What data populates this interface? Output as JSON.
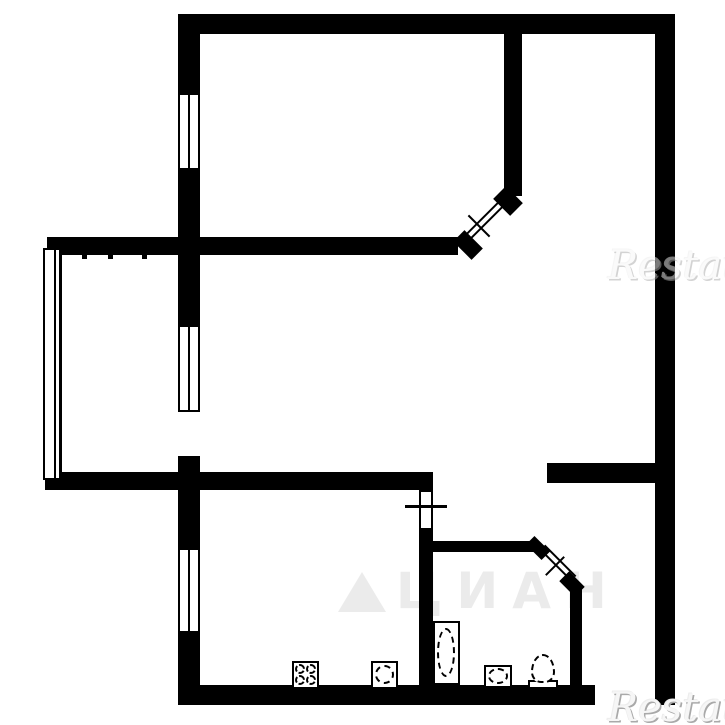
{
  "watermarks": {
    "brand_text": "Restate",
    "portal_text": "ЦИАН"
  },
  "colors": {
    "wall": "#000000",
    "background": "#ffffff",
    "portal_watermark": "#ebebeb",
    "brand_watermark": "#a9a9a9"
  },
  "plan": {
    "canvas": {
      "width": 725,
      "height": 725
    },
    "items": [
      {
        "name": "top-wall",
        "kind": "wall",
        "x": 178,
        "y": 14,
        "w": 497,
        "h": 20
      },
      {
        "name": "right-wall",
        "kind": "wall",
        "x": 655,
        "y": 14,
        "w": 20,
        "h": 691
      },
      {
        "name": "bedroom-left-wall-upper",
        "kind": "wall",
        "x": 178,
        "y": 14,
        "w": 22,
        "h": 79
      },
      {
        "name": "bedroom-left-wall-lower",
        "kind": "wall",
        "x": 178,
        "y": 170,
        "w": 22,
        "h": 85
      },
      {
        "name": "middle-wall",
        "kind": "wall",
        "x": 47,
        "y": 237,
        "w": 411,
        "h": 18
      },
      {
        "name": "bedroom-divider-wall",
        "kind": "wall",
        "x": 504,
        "y": 34,
        "w": 18,
        "h": 162
      },
      {
        "name": "balcony-door-wall-upper",
        "kind": "wall",
        "x": 178,
        "y": 255,
        "w": 22,
        "h": 70
      },
      {
        "name": "balcony-door-wall-lower",
        "kind": "wall",
        "x": 178,
        "y": 456,
        "w": 22,
        "h": 34
      },
      {
        "name": "lower-left-wall",
        "kind": "wall",
        "x": 45,
        "y": 472,
        "w": 388,
        "h": 18
      },
      {
        "name": "kitchen-left-wall-upper",
        "kind": "wall",
        "x": 178,
        "y": 490,
        "w": 22,
        "h": 58
      },
      {
        "name": "kitchen-left-wall-lower",
        "kind": "wall",
        "x": 178,
        "y": 633,
        "w": 22,
        "h": 72
      },
      {
        "name": "bottom-wall",
        "kind": "wall",
        "x": 178,
        "y": 685,
        "w": 417,
        "h": 20
      },
      {
        "name": "kitchen-bath-wall",
        "kind": "wall",
        "x": 419,
        "y": 530,
        "w": 14,
        "h": 160
      },
      {
        "name": "bathroom-top-wall",
        "kind": "wall",
        "x": 430,
        "y": 541,
        "w": 105,
        "h": 11
      },
      {
        "name": "bathroom-right-wall",
        "kind": "wall",
        "x": 570,
        "y": 588,
        "w": 12,
        "h": 102
      },
      {
        "name": "hall-wall",
        "kind": "wall",
        "x": 547,
        "y": 463,
        "w": 128,
        "h": 20
      },
      {
        "name": "wall-notch-1",
        "kind": "wall",
        "x": 82,
        "y": 255,
        "w": 5,
        "h": 4
      },
      {
        "name": "wall-notch-2",
        "kind": "wall",
        "x": 108,
        "y": 255,
        "w": 5,
        "h": 4
      },
      {
        "name": "wall-notch-3",
        "kind": "wall",
        "x": 142,
        "y": 255,
        "w": 5,
        "h": 4
      },
      {
        "name": "middle-wall-end-cap",
        "kind": "cap",
        "cx": 468,
        "cy": 245,
        "w": 26,
        "h": 16,
        "rot": 45
      },
      {
        "name": "bedroom-wall-end-cap",
        "kind": "cap",
        "cx": 508,
        "cy": 201,
        "w": 24,
        "h": 18,
        "rot": 45
      },
      {
        "name": "bathroom-wall-end-cap",
        "kind": "cap",
        "cx": 538,
        "cy": 548,
        "w": 22,
        "h": 12,
        "rot": 45
      },
      {
        "name": "bathroom-corner-cap",
        "kind": "cap",
        "cx": 572,
        "cy": 584,
        "w": 22,
        "h": 14,
        "rot": 45
      },
      {
        "name": "bedroom-window",
        "kind": "window",
        "x": 178,
        "y": 93,
        "w": 22,
        "h": 77
      },
      {
        "name": "balcony-door-window",
        "kind": "window",
        "x": 178,
        "y": 325,
        "w": 22,
        "h": 87
      },
      {
        "name": "kitchen-window",
        "kind": "window",
        "x": 178,
        "y": 548,
        "w": 22,
        "h": 85
      },
      {
        "name": "kitchen-bath-door-frame",
        "kind": "window",
        "x": 419,
        "y": 490,
        "w": 14,
        "h": 40,
        "mullion": false
      },
      {
        "name": "balcony-glazing",
        "kind": "glazing",
        "x": 43,
        "y": 248,
        "w": 19,
        "h": 232
      },
      {
        "name": "bedroom-door-leaf",
        "kind": "leaf",
        "cx": 485,
        "cy": 220,
        "len": 54,
        "rot": -45
      },
      {
        "name": "bedroom-door-tick",
        "kind": "tick",
        "cx": 479,
        "cy": 226,
        "len": 30,
        "rot": 45
      },
      {
        "name": "bathroom-door-leaf",
        "kind": "leaf",
        "cx": 558,
        "cy": 563,
        "len": 44,
        "rot": 45
      },
      {
        "name": "bathroom-door-tick",
        "kind": "tick",
        "cx": 555,
        "cy": 566,
        "len": 26,
        "rot": -45
      },
      {
        "name": "kitchen-door-mark",
        "kind": "mark",
        "x": 405,
        "y": 505,
        "w": 42,
        "h": 3
      },
      {
        "name": "stove",
        "kind": "frame",
        "x": 292,
        "y": 661,
        "w": 27,
        "h": 28
      },
      {
        "name": "stove-burner-1",
        "kind": "dashed-circle",
        "x": 295,
        "y": 664,
        "w": 10,
        "h": 10
      },
      {
        "name": "stove-burner-2",
        "kind": "dashed-circle",
        "x": 306,
        "y": 664,
        "w": 10,
        "h": 10
      },
      {
        "name": "stove-burner-3",
        "kind": "dashed-circle",
        "x": 295,
        "y": 675,
        "w": 10,
        "h": 10
      },
      {
        "name": "stove-burner-4",
        "kind": "dashed-circle",
        "x": 306,
        "y": 675,
        "w": 10,
        "h": 10
      },
      {
        "name": "kitchen-sink",
        "kind": "frame",
        "x": 371,
        "y": 661,
        "w": 27,
        "h": 28
      },
      {
        "name": "kitchen-sink-basin",
        "kind": "dashed-circle",
        "x": 375,
        "y": 665,
        "w": 19,
        "h": 19
      },
      {
        "name": "bathtub",
        "kind": "frame",
        "x": 433,
        "y": 621,
        "w": 27,
        "h": 64
      },
      {
        "name": "bathtub-basin",
        "kind": "dashed-ellipse",
        "x": 437,
        "y": 628,
        "w": 18,
        "h": 49
      },
      {
        "name": "washbasin",
        "kind": "frame",
        "x": 484,
        "y": 665,
        "w": 28,
        "h": 23
      },
      {
        "name": "washbasin-bowl",
        "kind": "dashed-ellipse",
        "x": 488,
        "y": 668,
        "w": 20,
        "h": 16
      },
      {
        "name": "toilet-tank",
        "kind": "frame",
        "x": 528,
        "y": 680,
        "w": 30,
        "h": 9
      },
      {
        "name": "toilet-bowl",
        "kind": "egg",
        "x": 531,
        "y": 654,
        "w": 24,
        "h": 29
      }
    ]
  }
}
